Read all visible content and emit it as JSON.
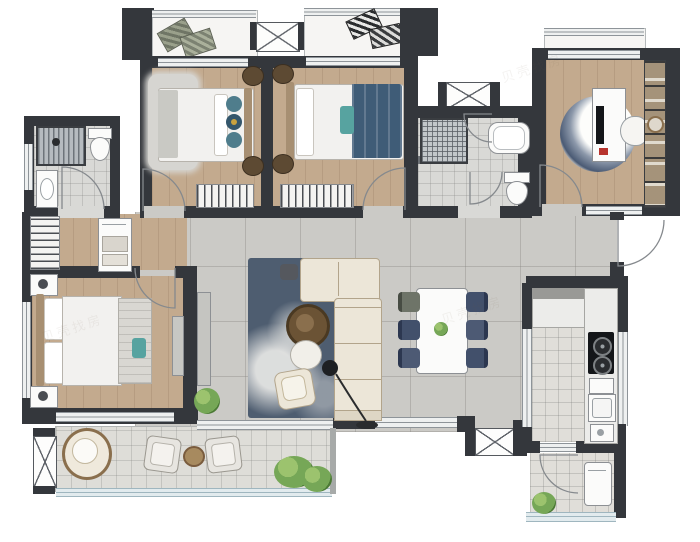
{
  "app": {
    "type": "apartment-floor-plan-rendering",
    "canvas": {
      "width": 700,
      "height": 542
    },
    "visible_text": "none (pictorial plan, faint repeated watermark only)"
  },
  "watermark": {
    "text": "贝壳找房"
  },
  "palette": {
    "wall": "#34373c",
    "wood": "#c3aa8e",
    "tile": "#cbcac6",
    "bath": "#d9d9d6",
    "kitchenFloor": "#e0ded9",
    "balcony": "#deddd8",
    "window": "#eef0f0",
    "windowLine": "#8e9499",
    "glass": "#e2ebee",
    "glassLine": "#9fb6bf",
    "bedding": "#f2f1ef",
    "sofa": "#ece6d8",
    "sofaLine": "#b2a48b",
    "rug": "#4e5d70",
    "teal": "#4f7d8c",
    "navy": "#3f5c77",
    "chairNavy": "#42506b",
    "green": "#76a757",
    "wicker": "#8a6f4d",
    "black": "#1e2023",
    "appliance": "#141619",
    "headboard": "#a78f72",
    "cabinet": "#f4f3f1",
    "counter": "#ececea"
  },
  "rooms": [
    {
      "name": "bedroom-2",
      "furniture": [
        "double-bed",
        "teal-pillows",
        "nightstands",
        "wardrobe-with-hangers",
        "rug"
      ]
    },
    {
      "name": "bedroom-3",
      "furniture": [
        "double-bed-navy-duvet",
        "round-nightstands",
        "wardrobe-with-hangers"
      ]
    },
    {
      "name": "bathroom-1",
      "furniture": [
        "striped-shower",
        "toilet",
        "washbasin"
      ]
    },
    {
      "name": "bathroom-2",
      "furniture": [
        "hatched-shower",
        "bathtub",
        "toilet"
      ]
    },
    {
      "name": "study",
      "furniture": [
        "desk",
        "monitor",
        "task-chair",
        "round-rug",
        "bookshelf"
      ]
    },
    {
      "name": "master-bedroom",
      "furniture": [
        "double-bed",
        "nightstands",
        "bench",
        "tv-cabinet",
        "closet-nook-wardrobes"
      ]
    },
    {
      "name": "living-room",
      "furniture": [
        "l-shaped-sofa",
        "slate-rug",
        "round-coffee-tables",
        "armchair",
        "arc-floor-lamp",
        "tv-bench",
        "potted-plant"
      ]
    },
    {
      "name": "dining-area",
      "furniture": [
        "dining-table",
        "six-chairs",
        "centerpiece-plant"
      ]
    },
    {
      "name": "kitchen",
      "furniture": [
        "counters",
        "two-burner-cooktop",
        "double-sink",
        "prep-sink"
      ]
    },
    {
      "name": "utility-balcony",
      "furniture": [
        "washing-machine",
        "potted-plant"
      ]
    },
    {
      "name": "main-balcony",
      "furniture": [
        "round-wicker-chair",
        "two-cube-chairs",
        "round-side-table",
        "plants"
      ]
    }
  ]
}
